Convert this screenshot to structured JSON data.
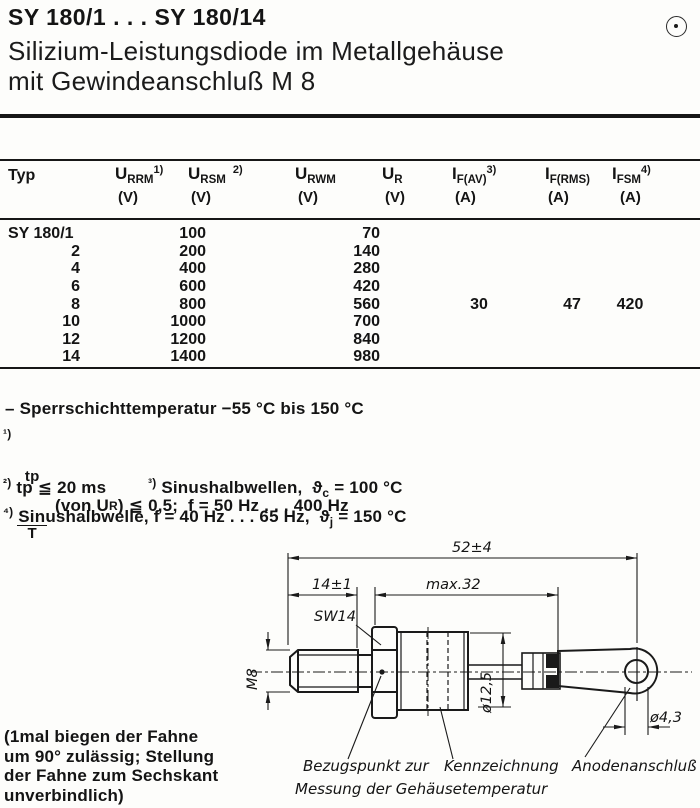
{
  "header": {
    "part_range": "SY 180/1 . . . SY 180/14",
    "subtitle_line1": "Silizium-Leistungsdiode im Metallgehäuse",
    "subtitle_line2": "mit Gewindeanschluß M 8",
    "corner_symbol": "circle-dot-icon"
  },
  "table": {
    "columns": [
      {
        "label": "Typ"
      },
      {
        "sym": "U",
        "sub": "RRM",
        "sup": "1)",
        "unit": "(V)"
      },
      {
        "sym": "U",
        "sub": "RSM",
        "sup": "2)",
        "unit": "(V)"
      },
      {
        "sym": "U",
        "sub": "RWM",
        "sup": "",
        "unit": "(V)"
      },
      {
        "sym": "U",
        "sub": "R",
        "sup": "",
        "unit": "(V)"
      },
      {
        "sym": "I",
        "sub": "F(AV)",
        "sup": "3)",
        "unit": "(A)"
      },
      {
        "sym": "I",
        "sub": "F(RMS)",
        "sup": "",
        "unit": "(A)"
      },
      {
        "sym": "I",
        "sub": "FSM",
        "sup": "4)",
        "unit": "(A)"
      }
    ],
    "rows": [
      {
        "typ": "SY 180/1",
        "urrm": "100",
        "urwm": "70",
        "ifav": "",
        "ifrms": "",
        "ifsm": ""
      },
      {
        "typ": "2",
        "urrm": "200",
        "urwm": "140",
        "ifav": "",
        "ifrms": "",
        "ifsm": ""
      },
      {
        "typ": "4",
        "urrm": "400",
        "urwm": "280",
        "ifav": "",
        "ifrms": "",
        "ifsm": ""
      },
      {
        "typ": "6",
        "urrm": "600",
        "urwm": "420",
        "ifav": "",
        "ifrms": "",
        "ifsm": ""
      },
      {
        "typ": "8",
        "urrm": "800",
        "urwm": "560",
        "ifav": "30",
        "ifrms": "47",
        "ifsm": "420"
      },
      {
        "typ": "10",
        "urrm": "1000",
        "urwm": "700",
        "ifav": "",
        "ifrms": "",
        "ifsm": ""
      },
      {
        "typ": "12",
        "urrm": "1200",
        "urwm": "840",
        "ifav": "",
        "ifrms": "",
        "ifsm": ""
      },
      {
        "typ": "14",
        "urrm": "1400",
        "urwm": "980",
        "ifav": "",
        "ifrms": "",
        "ifsm": ""
      }
    ]
  },
  "notes": {
    "temp": "– Sperrschichttemperatur −55 °C bis 150 °C",
    "n1": {
      "sup": "¹)",
      "frac_num": "tp",
      "frac_den": "T",
      "text_a": "(von U",
      "sub": "R",
      "text_b": ") ≦ 0,5;  f = 50 Hz . . . 400 Hz"
    },
    "n2": {
      "sup": "²)",
      "text": " tp ≦ 20 ms"
    },
    "n3": {
      "sup": "³)",
      "text": " Sinushalbwellen,  ",
      "theta": "ϑ",
      "sub": "c",
      "rest": " = 100 °C"
    },
    "n4": {
      "sup": "⁴)",
      "text": " Sinushalbwelle, f = 40 Hz . . . 65 Hz,  ",
      "theta": "ϑ",
      "sub": "j",
      "rest": " = 150 °C"
    }
  },
  "drawing": {
    "dim_52": "52±4",
    "dim_14": "14±1",
    "dim_max32": "max.32",
    "sw14": "SW14",
    "m8": "M8",
    "dia_125": "ø12,5",
    "dia_43": "ø4,3",
    "label_ref_line1": "Bezugspunkt zur",
    "label_ref_line2": "Messung der Gehäusetemperatur",
    "label_marking": "Kennzeichnung",
    "label_anode": "Anodenanschluß"
  },
  "footer_note": {
    "line1": "(1mal biegen der Fahne",
    "line2": "um 90° zulässig; Stellung",
    "line3": "der Fahne zum Sechskant",
    "line4": "unverbindlich)"
  }
}
